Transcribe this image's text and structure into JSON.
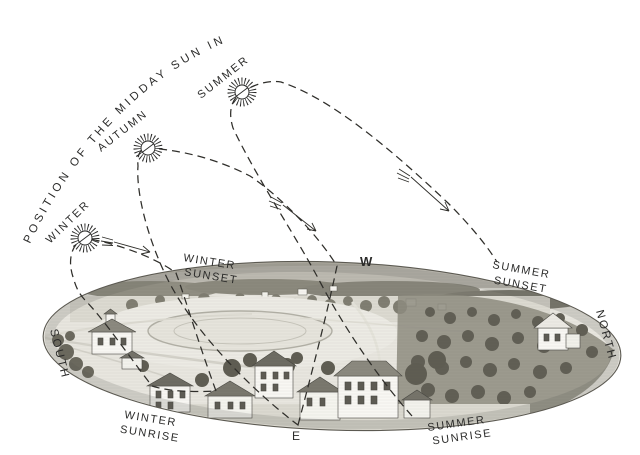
{
  "title": "POSITION OF THE MIDDAY SUN IN",
  "seasons": {
    "winter": "WINTER",
    "autumn": "AUTUMN",
    "summer": "SUMMER"
  },
  "horizon_events": {
    "winter_sunset": {
      "line1": "WINTER",
      "line2": "SUNSET"
    },
    "summer_sunset": {
      "line1": "SUMMER",
      "line2": "SUNSET"
    },
    "winter_sunrise": {
      "line1": "WINTER",
      "line2": "SUNRISE"
    },
    "summer_sunrise": {
      "line1": "SUMMER",
      "line2": "SUNRISE"
    }
  },
  "compass": {
    "south": "SOUTH",
    "west": "W",
    "east": "E",
    "north": "NORTH"
  },
  "icons": {
    "winter_sun": "sun-icon",
    "autumn_sun": "sun-icon",
    "summer_sun": "sun-icon",
    "direction_arrows": "feathered-arrow-icon"
  },
  "colors": {
    "ink": "#2b2b2a",
    "background": "#ffffff",
    "landscape_light": "#e8e6df",
    "landscape_mid": "#b9b6ac",
    "landscape_dark": "#57554c"
  }
}
